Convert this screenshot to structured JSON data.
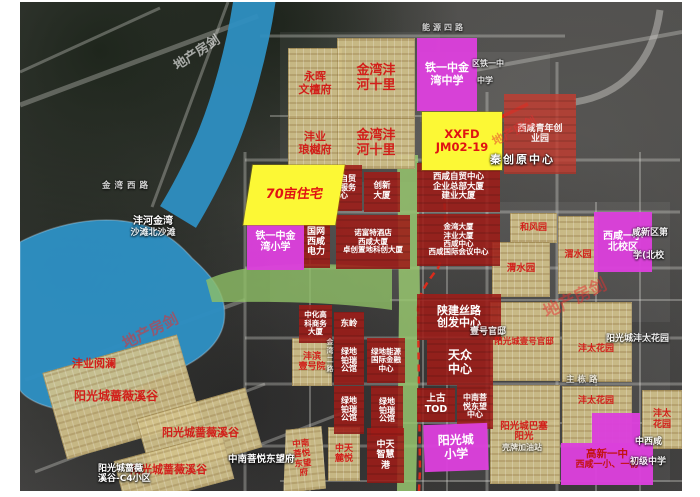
{
  "water": {
    "lake_name": "沣河金湾",
    "lake_sub": "沙滩北沙滩"
  },
  "parcels": {
    "yonghui": [
      "永晖",
      "文檀府"
    ],
    "jinwan_shili": [
      "金湾沣",
      "河十里"
    ],
    "langyue": [
      "沣业",
      "琅樾府"
    ],
    "hefengyuan": [
      "和风园"
    ],
    "weishuiyuan": [
      "渭水园"
    ],
    "fengbin": [
      "沣滨",
      "壹号院"
    ],
    "yuelan": [
      "沣业阅澜"
    ],
    "qiangwei": [
      "阳光城蔷薇溪谷"
    ],
    "yihao_guandi": [
      "阳光城壹号官邸"
    ],
    "fengtai": [
      "沣太花园"
    ],
    "fengtai_v": [
      "沣太",
      "花园"
    ],
    "basai": [
      "阳光城巴塞",
      "阳光"
    ],
    "luyue": [
      "中天",
      "麓悦"
    ],
    "zhongnan_fu": [
      "中南",
      "菩悦",
      "东望",
      "府"
    ]
  },
  "projects": {
    "zimao_service": [
      "西咸自贸",
      "企业服务",
      "中心"
    ],
    "chuangxin": [
      "创新",
      "大厦"
    ],
    "guowang": [
      "国网",
      "西咸",
      "电力"
    ],
    "nuofute": [
      "诺富特酒店",
      "西咸大厦",
      "卓创置地科创大厦"
    ],
    "zimao_center": [
      "西咸自贸中心",
      "企业总部大厦",
      "建业大厦"
    ],
    "jinwan_towers": [
      "金湾大厦",
      "沣业大厦",
      "西咸中心",
      "西咸国际会议中心"
    ],
    "qingnian": [
      "西咸青年创",
      "业园"
    ],
    "shaanjian": [
      "陕建丝路",
      "创发中心"
    ],
    "tianzhong": [
      "天众",
      "中心"
    ],
    "shanggu": [
      "上古",
      "TOD"
    ],
    "zhongnan_center": [
      "中南菩",
      "悦东望",
      "中心"
    ],
    "dongling": [
      "东岭"
    ],
    "zhonghua": [
      "中化高",
      "科商务",
      "大厦"
    ],
    "lvdi_borui": [
      "绿地",
      "铂瑞",
      "公馆"
    ],
    "lvdi_energy": [
      "绿地能源",
      "国际金融",
      "中心"
    ],
    "zhongtian_port": [
      "中天",
      "智慧",
      "港"
    ]
  },
  "schools": {
    "tieyi_middle": [
      "铁一中金",
      "湾中学"
    ],
    "tieyi_primary": [
      "铁一中金",
      "湾小学"
    ],
    "beixiaoqu": [
      "西咸一小",
      "北校区"
    ],
    "yangguang_primary": [
      "阳光城",
      "小学"
    ],
    "gaoxin": [
      "高新一中",
      "西咸一小、一初"
    ]
  },
  "highlights": {
    "plot70": "70亩住宅",
    "xxfd": [
      "XXFD",
      "JM02-19"
    ]
  },
  "bg_labels": {
    "jinwan_xilu": "金湾西路",
    "nengyuan_silu": "能源四路",
    "qinchuangyuan": "秦创原中心",
    "xianxin_1": "咸新区第",
    "xianxin_2": "学(北校",
    "tieyi_bg1": "区铁一中",
    "tieyi_bg2": "中学",
    "yihao_bg": "壹号官邸",
    "zhudong_road": "主栋路",
    "fengtai_bg": "阳光城沣太花园",
    "zhongnan_bg": "中南菩悦东望府",
    "c4_1": "阳光城蔷薇",
    "c4_2": "溪谷-C4小区",
    "shell": "壳牌加油站",
    "zhongxixian": "中西咸",
    "chuji": "初级中学",
    "jinwan_erlu": "金湾二路"
  },
  "watermark": "地产房剑",
  "colors": {
    "water": "#2e8fc2",
    "green": "#93c16a",
    "tan": "#d5c48c",
    "red_block": "#9e1d18",
    "magenta": "#db40db",
    "yellow": "#fcf835",
    "label_red": "#d21f1a",
    "dashed_line": "#e22a1a"
  }
}
